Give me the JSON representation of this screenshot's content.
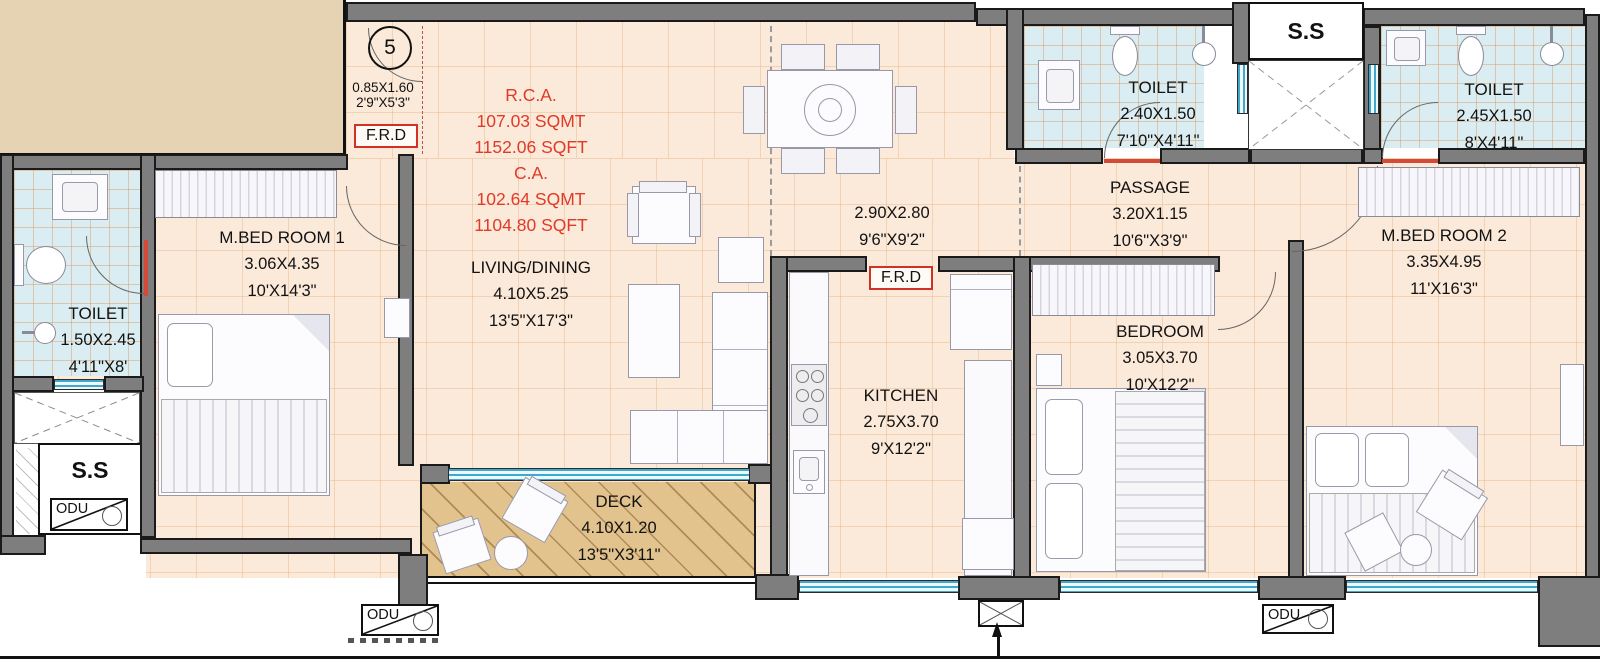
{
  "colors": {
    "wall": "#7e7e7e",
    "wall_outline": "#1a1a1a",
    "floor_peach": "#fbe9d9",
    "toilet_tile": "#d9edf3",
    "deck_wood": "#e2c28d",
    "adjacent_block_tan": "#e5d3b4",
    "dimension_red": "#e03a28",
    "window_blue": "#3fa8cc"
  },
  "unit": {
    "number": "5",
    "ss_label": "S.S",
    "odu_label": "ODU",
    "frd_label": "F.R.D",
    "entry_dim_m": "0.85X1.60",
    "entry_dim_ft": "2'9\"X5'3\"",
    "area": {
      "rca_title": "R.C.A.",
      "rca_sqmt": "107.03 SQMT",
      "rca_sqft": "1152.06 SQFT",
      "ca_title": "C.A.",
      "ca_sqmt": "102.64 SQMT",
      "ca_sqft": "1104.80 SQFT"
    }
  },
  "rooms": [
    {
      "id": "mbed1",
      "name": "M.BED ROOM 1",
      "dim_m": "3.06X4.35",
      "dim_ft": "10'X14'3\""
    },
    {
      "id": "toilet1",
      "name": "TOILET",
      "dim_m": "1.50X2.45",
      "dim_ft": "4'11\"X8'"
    },
    {
      "id": "living",
      "name": "LIVING/DINING",
      "dim_m": "4.10X5.25",
      "dim_ft": "13'5\"X17'3\""
    },
    {
      "id": "deck",
      "name": "DECK",
      "dim_m": "4.10X1.20",
      "dim_ft": "13'5\"X3'11\""
    },
    {
      "id": "foyer",
      "name": "",
      "dim_m": "2.90X2.80",
      "dim_ft": "9'6\"X9'2\""
    },
    {
      "id": "kitchen",
      "name": "KITCHEN",
      "dim_m": "2.75X3.70",
      "dim_ft": "9'X12'2\""
    },
    {
      "id": "passage",
      "name": "PASSAGE",
      "dim_m": "3.20X1.15",
      "dim_ft": "10'6\"X3'9\""
    },
    {
      "id": "toilet2",
      "name": "TOILET",
      "dim_m": "2.40X1.50",
      "dim_ft": "7'10\"X4'11\""
    },
    {
      "id": "toilet3",
      "name": "TOILET",
      "dim_m": "2.45X1.50",
      "dim_ft": "8'X4'11\""
    },
    {
      "id": "bedroom",
      "name": "BEDROOM",
      "dim_m": "3.05X3.70",
      "dim_ft": "10'X12'2\""
    },
    {
      "id": "mbed2",
      "name": "M.BED ROOM 2",
      "dim_m": "3.35X4.95",
      "dim_ft": "11'X16'3\""
    }
  ]
}
